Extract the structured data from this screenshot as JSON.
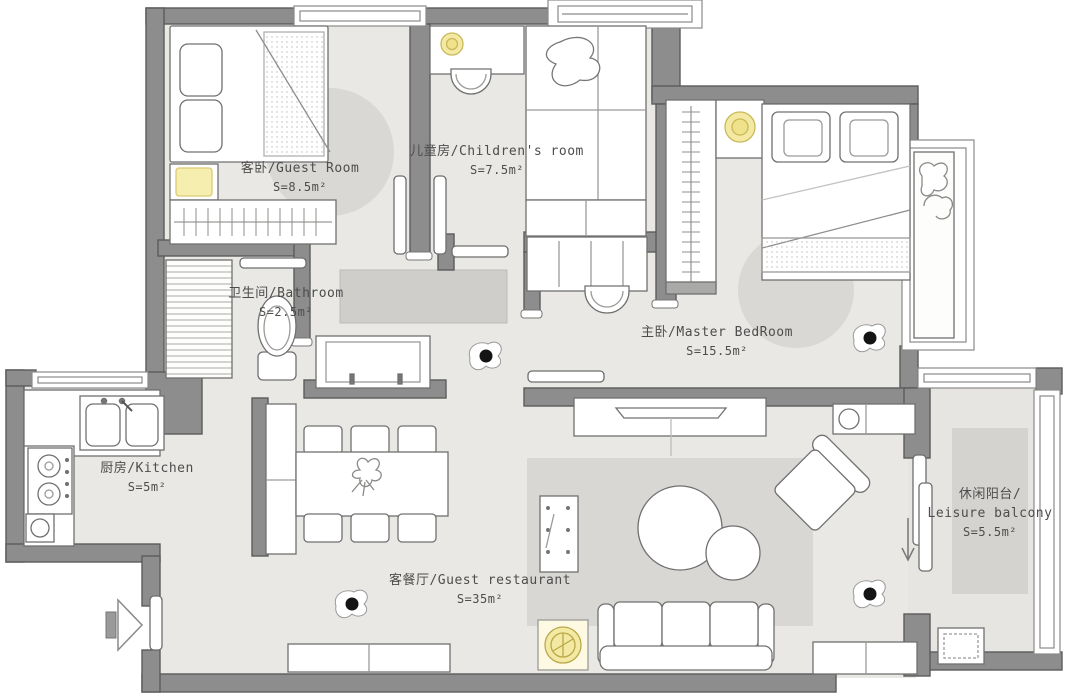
{
  "title": "Apartment floor plan",
  "rooms": [
    {
      "id": "guest-room",
      "label": "客卧/Guest Room",
      "area": "S=8.5m²"
    },
    {
      "id": "children-room",
      "label": "儿童房/Children's room",
      "area": "S=7.5m²"
    },
    {
      "id": "bathroom",
      "label": "卫生间/Bathroom",
      "area": "S=2.5m²"
    },
    {
      "id": "master-bedroom",
      "label": "主卧/Master BedRoom",
      "area": "S=15.5m²"
    },
    {
      "id": "kitchen",
      "label": "厨房/Kitchen",
      "area": "S=5m²"
    },
    {
      "id": "living-dining",
      "label": "客餐厅/Guest restaurant",
      "area": "S=35m²"
    },
    {
      "id": "leisure-balcony",
      "label": "休闲阳台/",
      "label2": "Leisure balcony",
      "area": "S=5.5m²"
    }
  ],
  "colors": {
    "wall": "#8d8d8d",
    "wall_stroke": "#5c5c5c",
    "floor": "#e9e8e5",
    "rug": "#d8d7d4",
    "corridor_block": "#cfcecb",
    "furniture_stroke": "#707070",
    "lamp": "#f3e9a2",
    "text": "#4d4d4d"
  }
}
